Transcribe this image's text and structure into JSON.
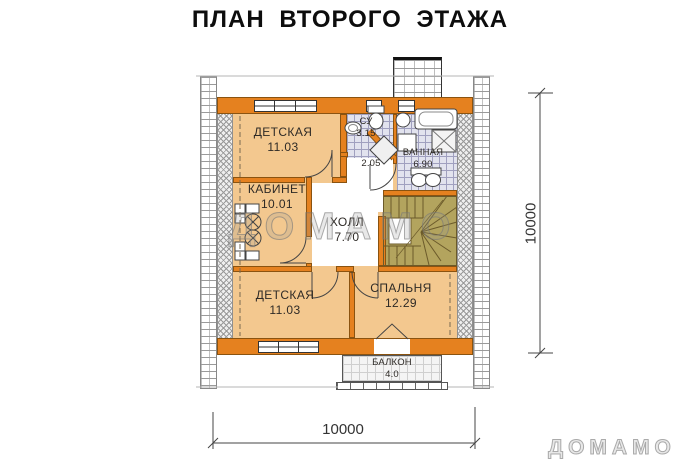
{
  "title": "ПЛАН ВТОРОГО ЭТАЖА",
  "watermarks": {
    "center": "ДОМАМО",
    "corner": "ДОМАМО"
  },
  "dimensions": {
    "right": "10000",
    "bottom": "10000"
  },
  "rooms": [
    {
      "id": "detskaya-top",
      "name": "ДЕТСКАЯ",
      "area": "11.03"
    },
    {
      "id": "kabinet",
      "name": "КАБИНЕТ",
      "area": "10.01"
    },
    {
      "id": "holl",
      "name": "ХОЛЛ",
      "area": "7.70"
    },
    {
      "id": "su",
      "name": "СУ",
      "area": "3.15"
    },
    {
      "id": "corridor",
      "name": "",
      "area": "2.05"
    },
    {
      "id": "vannaya",
      "name": "ВАННАЯ",
      "area": "6.90"
    },
    {
      "id": "detskaya-bottom",
      "name": "ДЕТСКАЯ",
      "area": "11.03"
    },
    {
      "id": "spalnya",
      "name": "СПАЛЬНЯ",
      "area": "12.29"
    },
    {
      "id": "balkon",
      "name": "БАЛКОН",
      "area": "4.0"
    }
  ],
  "colors": {
    "wall": "#e5811f",
    "floor": "#f3c88f",
    "stairs": "#b3a45e",
    "bath_tile": "#e2e3ee",
    "linework": "#444444"
  }
}
